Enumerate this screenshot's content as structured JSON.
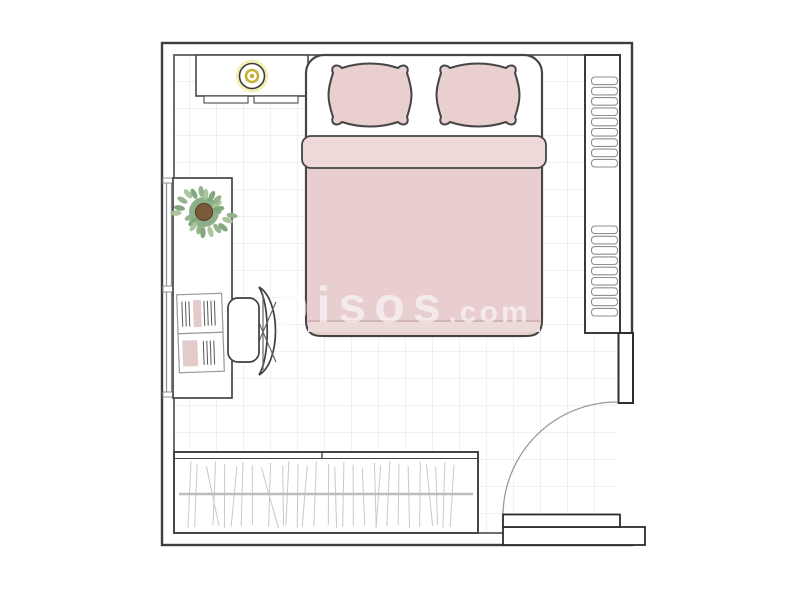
{
  "watermark": {
    "brand": "pisos",
    "tld": ".com",
    "color": "#ffffff",
    "opacity": 0.58
  },
  "colors": {
    "wall_outline": "#3d3d3d",
    "furniture_outline": "#454545",
    "floor_grid": "#e3e3e3",
    "bedding_pink": "#e8cecf",
    "pillow_pink": "#e9cfd0",
    "sheet_fold_pink": "#efd8d8",
    "duvet_hem_pink": "#eed9d9",
    "lamp_glow_yellow": "#f6f0ba",
    "lamp_ring_yellow": "#c3b23a",
    "plant_greens": [
      "#8fb087",
      "#7da377",
      "#a6c29a"
    ],
    "plant_soil_brown": "#7b5a3c",
    "book_accent_pink": "#e4cbcb",
    "clothes_line_gray": "#c9c9c9",
    "rail_gray": "#bcbcbc",
    "slat_outline_gray": "#8f8f8f",
    "door_arc_gray": "#9a9a9a",
    "window_gray": "#8f8f8f"
  },
  "floorplan": {
    "room_type": "bedroom",
    "furniture": [
      "double-bed",
      "pillow-left",
      "pillow-right",
      "duvet",
      "sheet-fold",
      "dresser",
      "ceiling-lamp",
      "wall-shelf",
      "desk",
      "office-chair",
      "potted-plant",
      "open-book",
      "wardrobe-with-hanging-clothes",
      "window",
      "door"
    ],
    "shelf": {
      "slat_groups": 2,
      "slats_per_group": 9
    },
    "wardrobe": {
      "clothes_lines": 30
    },
    "plant": {
      "leaves": 22
    }
  }
}
